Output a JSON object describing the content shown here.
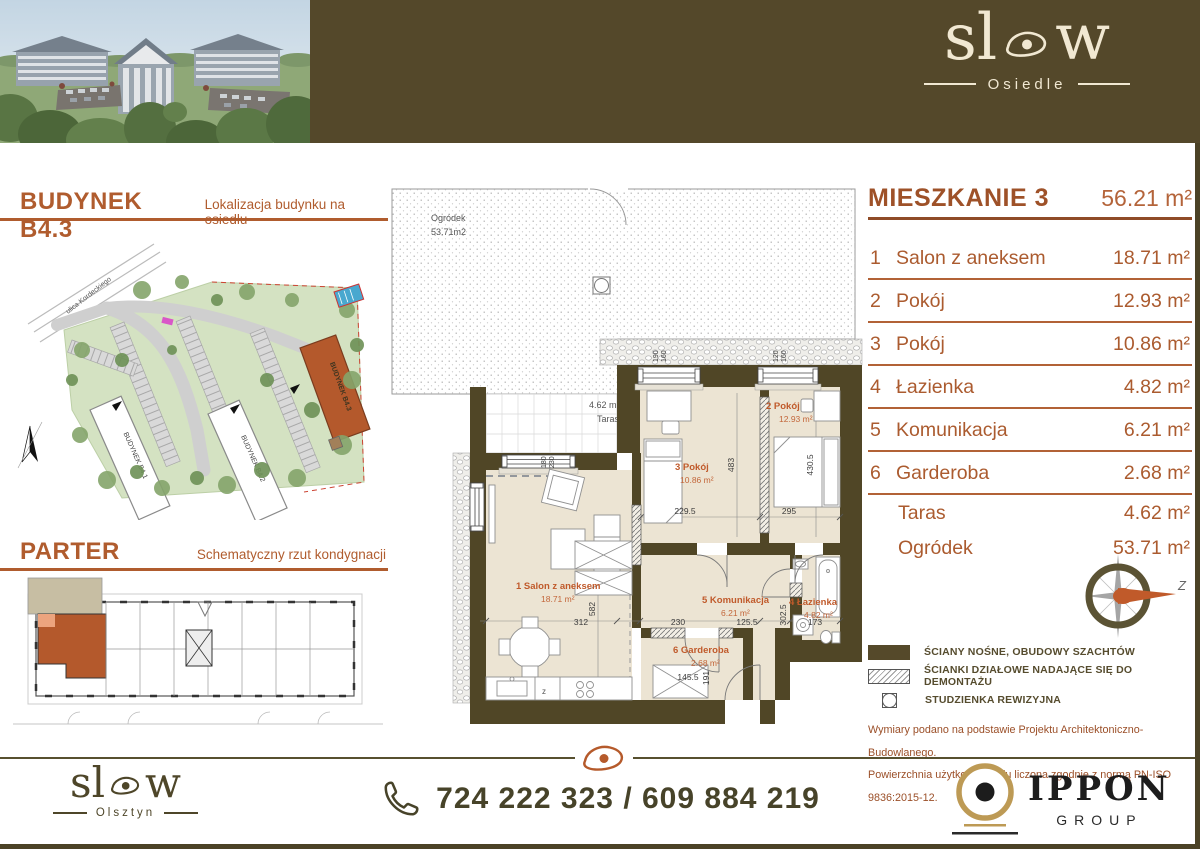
{
  "banner": {
    "logo_start": "sl",
    "logo_end": "w",
    "subtitle": "Osiedle"
  },
  "left": {
    "building_title": "BUDYNEK B4.3",
    "building_subtitle": "Lokalizacja budynku na osiedlu",
    "floor_title": "PARTER",
    "floor_subtitle": "Schematyczny rzut kondygnacji",
    "site_map": {
      "street": "ulica Kordeckiego",
      "building1": "BUDYNEK B4.1",
      "building2": "BUDYNEK B4.2",
      "building3": "BUDYNEK B4.3"
    }
  },
  "apartment": {
    "title": "MIESZKANIE 3",
    "total_area": "56.21 m²",
    "rooms": [
      {
        "no": "1",
        "name": "Salon z aneksem",
        "area": "18.71 m²"
      },
      {
        "no": "2",
        "name": "Pokój",
        "area": "12.93 m²"
      },
      {
        "no": "3",
        "name": "Pokój",
        "area": "10.86 m²"
      },
      {
        "no": "4",
        "name": "Łazienka",
        "area": "4.82 m²"
      },
      {
        "no": "5",
        "name": "Komunikacja",
        "area": "6.21 m²"
      },
      {
        "no": "6",
        "name": "Garderoba",
        "area": "2.68 m²"
      }
    ],
    "extras": [
      {
        "name": "Taras",
        "area": "4.62 m²"
      },
      {
        "name": "Ogródek",
        "area": "53.71 m²"
      }
    ],
    "compass_label": "Z"
  },
  "plan": {
    "garden_label": "Ogródek",
    "garden_area": "53.71m2",
    "terrace_area": "4.62 m2",
    "terrace_label": "Taras",
    "labels": [
      "1 Salon z aneksem",
      "2 Pokój",
      "3 Pokój",
      "4 Łazienka",
      "5 Komunikacja",
      "6 Garderoba"
    ],
    "kitchen_mark": "z",
    "dims": {
      "salon_w": "312",
      "salon_h": "582",
      "room3_w": "229.5",
      "room2_w": "295",
      "room3_h": "483",
      "room2_h": "430.5",
      "hall_w1": "230",
      "hall_w2": "125.5",
      "bath_h": "302.5",
      "bath_w": "173",
      "gard_w": "145.5",
      "gard_h": "191",
      "win1_a": "190",
      "win1_b": "160",
      "win2_a": "120",
      "win2_b": "160",
      "win3_a": "180",
      "win3_b": "230"
    }
  },
  "legend": {
    "item1": "ŚCIANY NOŚNE, OBUDOWY SZACHTÓW",
    "item2": "ŚCIANKI DZIAŁOWE NADAJĄCE SIĘ DO DEMONTAŻU",
    "item3": "STUDZIENKA REWIZYJNA",
    "disclaimer1": "Wymiary podano na podstawie Projektu Architektoniczno-Budowlanego.",
    "disclaimer2": "Powierzchnia użytkowa lokalu liczona zgodnie z normą PN-ISO 9836:2015-12."
  },
  "footer": {
    "logo_start": "sl",
    "logo_end": "w",
    "logo_subtitle": "Olsztyn",
    "phone": "724 222 323 / 609 884 219",
    "partner_name": "IPPON",
    "partner_subtitle": "GROUP"
  }
}
